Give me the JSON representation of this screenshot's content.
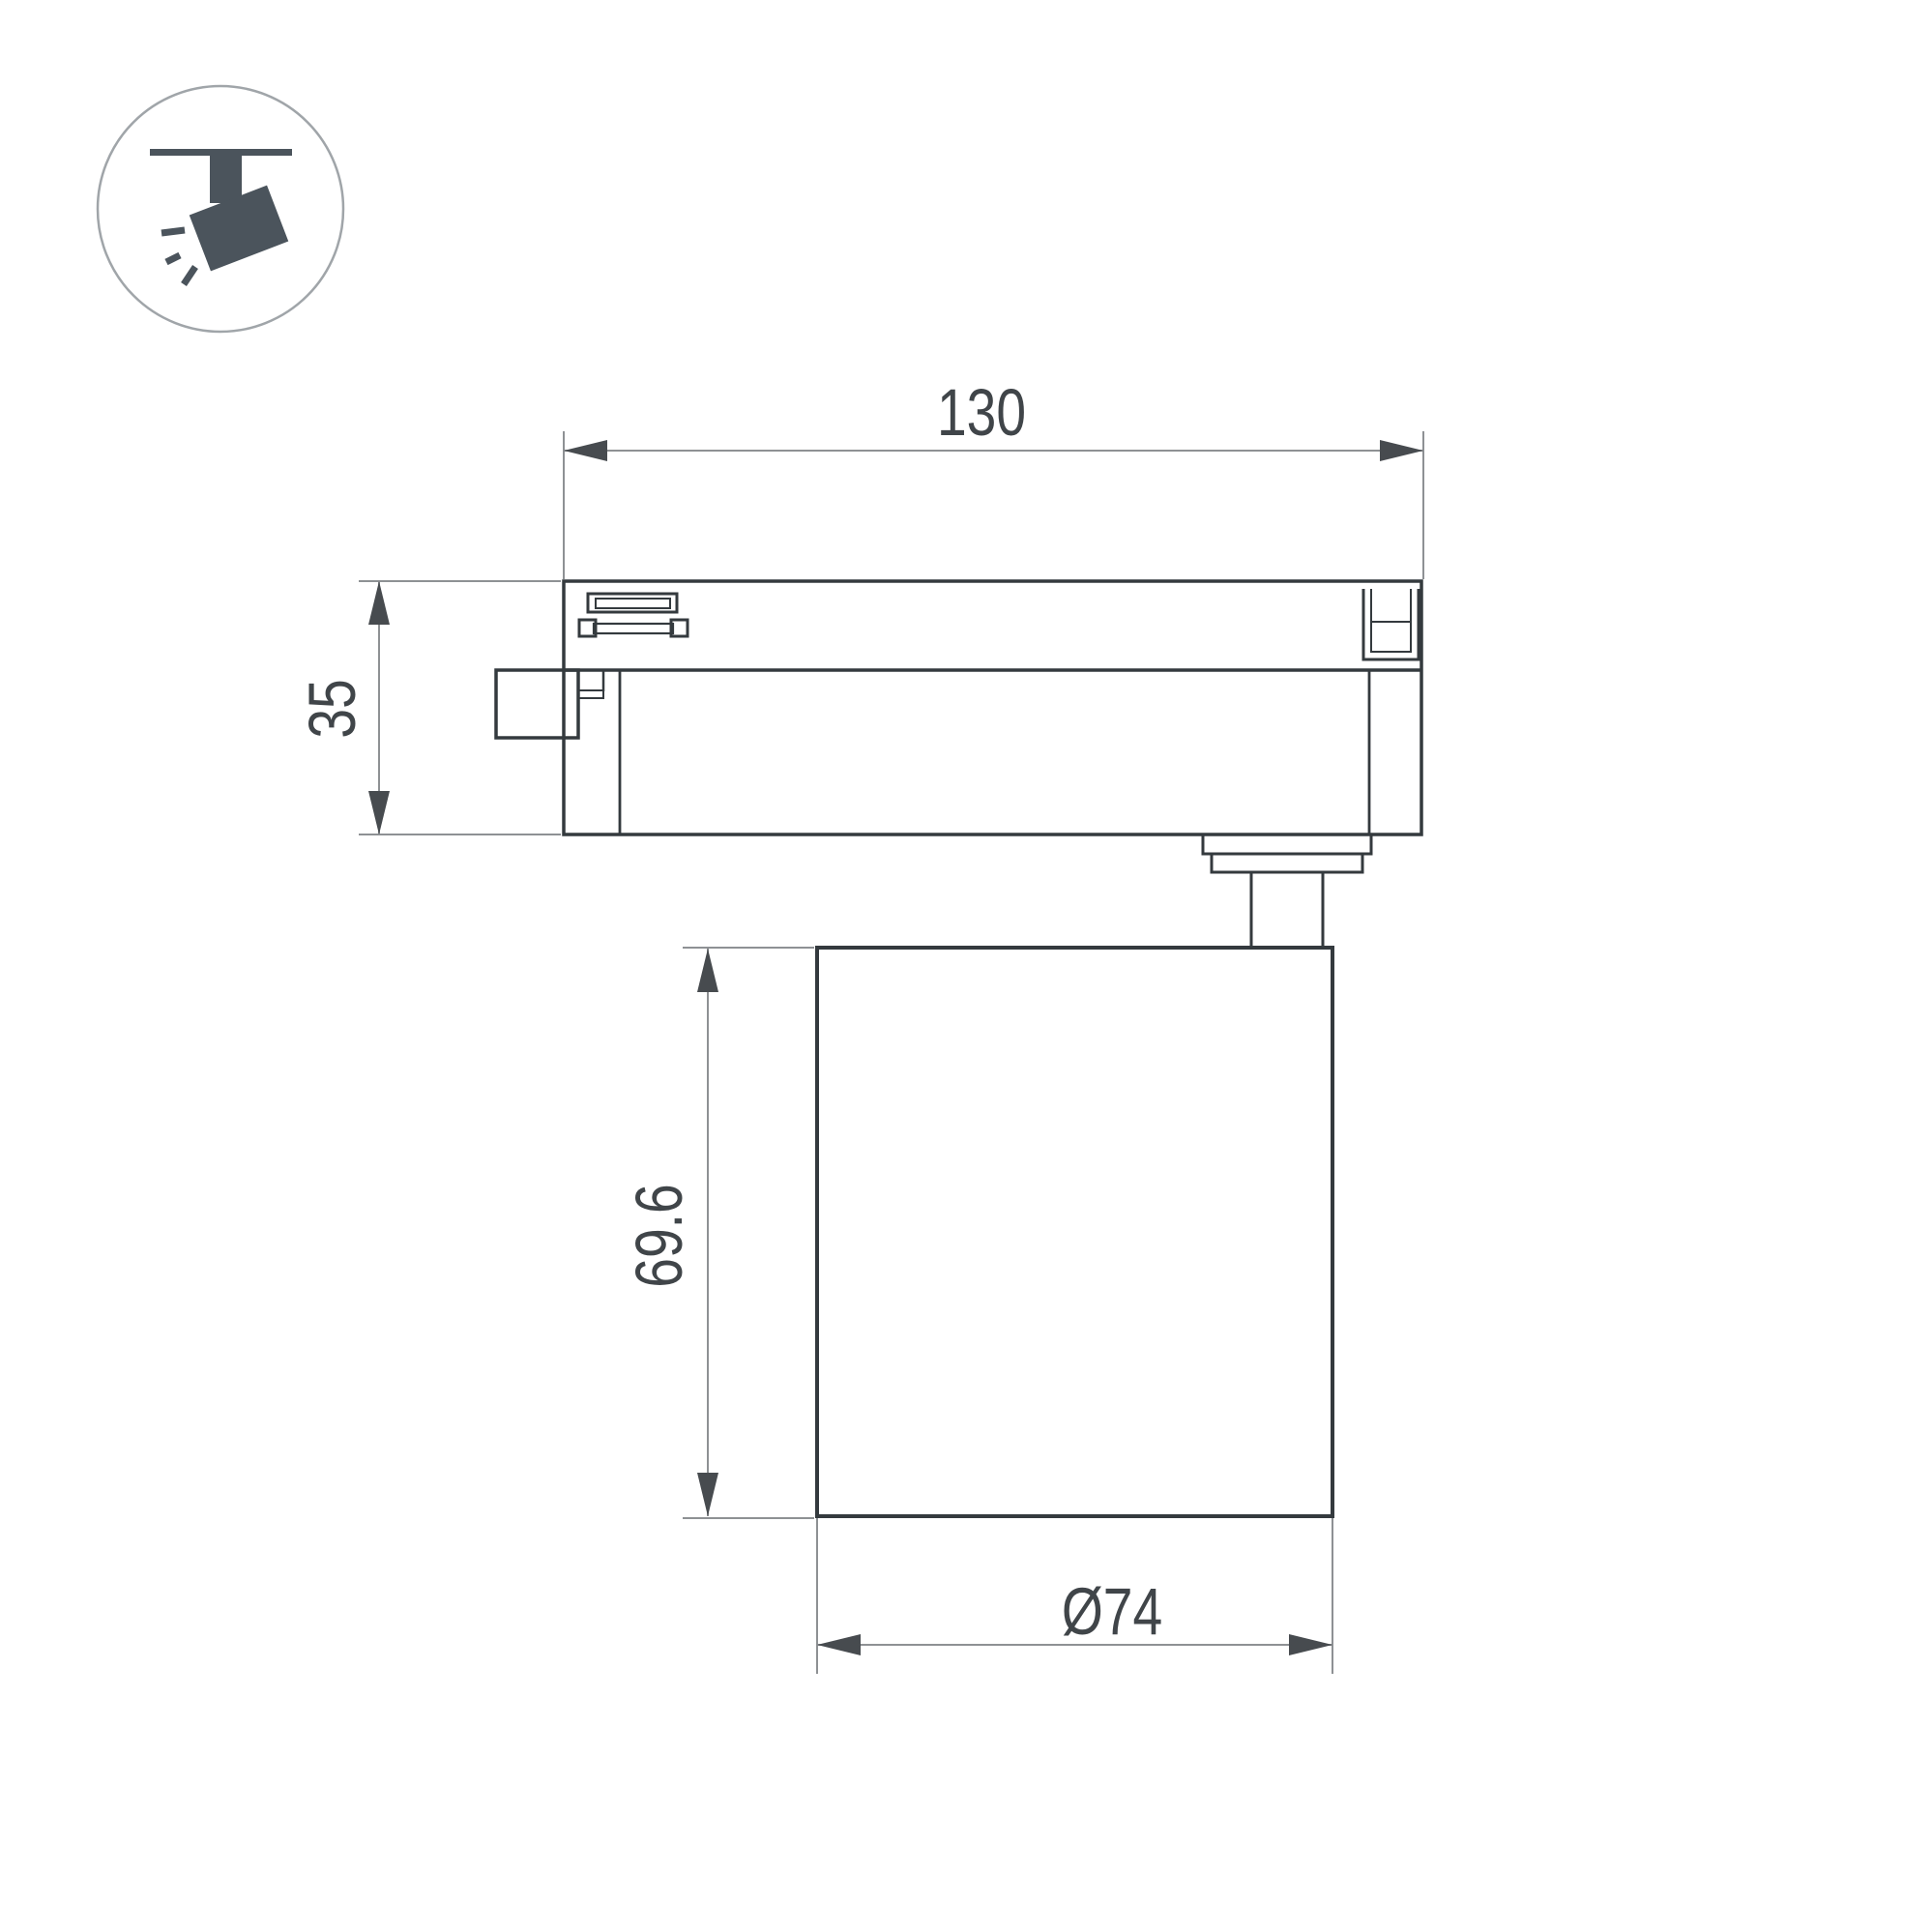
{
  "icons": {
    "badge": "track-spotlight-icon"
  },
  "drawing": {
    "dimension_labels": {
      "overall_width": "130",
      "adapter_height": "35",
      "head_height": "69.6",
      "head_diameter": "Ø74"
    }
  },
  "colors": {
    "outline": "#343a3e",
    "detail": "#3a3e42",
    "dim_line": "#8e9194",
    "arrow": "#474b4f",
    "text": "#404549",
    "icon": "#4b545c",
    "icon_circle": "#a0a5a9"
  }
}
